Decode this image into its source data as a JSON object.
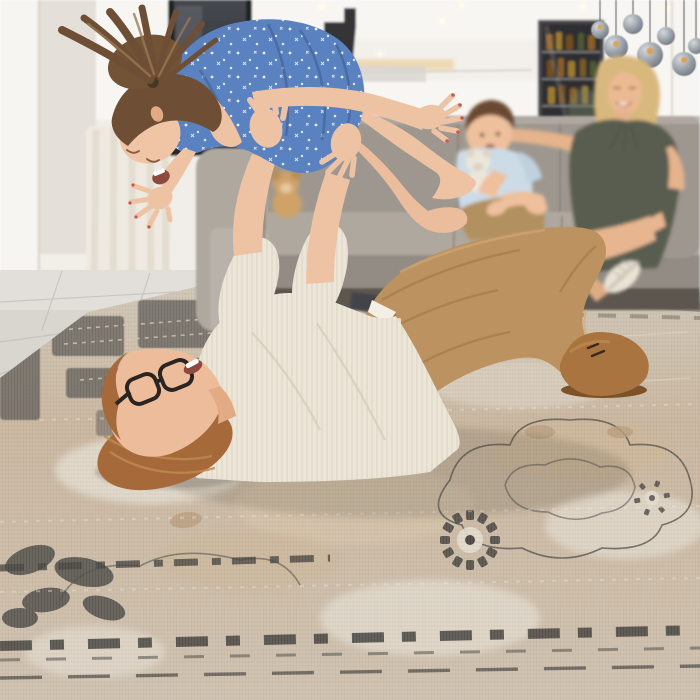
{
  "scene": {
    "type": "photograph",
    "description": "Bright modern living room: father lying on a distressed vintage beige-and-grey area rug lifting his laughing daughter airplane-style; blonde mother and toddler boy with a teddy bear watch from a grey sofa; staircase, drinks cabinet and smoked-glass pendant lights in the background.",
    "figures": [
      "daughter-lifted-in-air",
      "father-lying-on-rug",
      "mother-on-sofa",
      "toddler-on-sofa"
    ],
    "objects": [
      "area-rug",
      "grey-sofa",
      "teddy-bear",
      "pendant-lights",
      "drinks-cabinet",
      "staircase",
      "curtains",
      "tile-floor"
    ]
  },
  "palette": {
    "wall": "#f1ede8",
    "wall_bright": "#f7f5f1",
    "wall_shadow": "#e4dfd8",
    "dark_glass": "#34373d",
    "stairs": "#232327",
    "cabinet_bg": "#2f2e31",
    "bottle_amber": "#8a5f26",
    "pendant_glass": "#868c95",
    "pendant_bulb": "#dca24f",
    "curtain": "#efeae1",
    "floor": "#d9d5cf",
    "grout": "#c2bdb6",
    "rug_field": "#c8b59d",
    "rug_cream": "#e8e2d7",
    "rug_tan": "#bfa384",
    "rug_charcoal": "#4c4a45",
    "sofa": "#9e978f",
    "sofa_light": "#aea89f",
    "sofa_dark": "#7a746c",
    "sofa_base": "#5b564f",
    "skin": "#eec3a3",
    "skin_shadow": "#d9a47f",
    "dress_blue": "#5b82c0",
    "dress_fold": "#44639a",
    "girl_hair": "#6e4f36",
    "father_hair": "#a5693a",
    "shirt_cream": "#ece6d9",
    "pants_khaki": "#bc9260",
    "belt_leather": "#b5713a",
    "boot_suede": "#a9743f",
    "mother_top": "#595d50",
    "mother_hair": "#d8b87d",
    "boy_shirt": "#ccdbe6",
    "boy_shorts": "#b2905f",
    "boy_hair": "#6b4a33",
    "teddy_white": "#ece6da",
    "teddy_tan": "#cfa368",
    "sneaker": "#e9e3d5"
  }
}
